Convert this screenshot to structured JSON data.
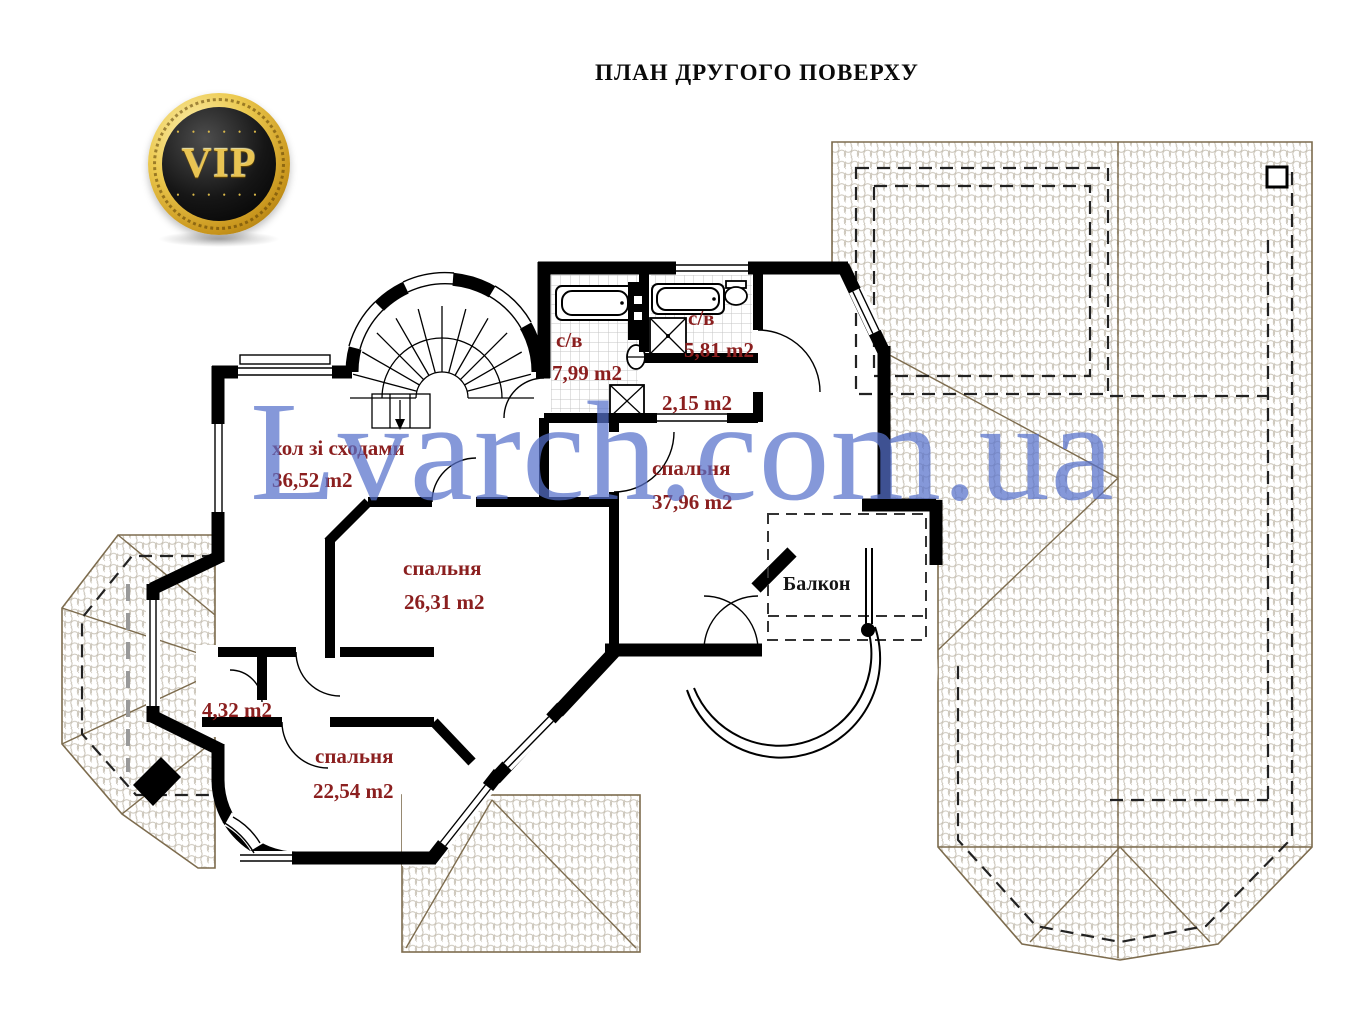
{
  "page": {
    "title": "ПЛАН ДРУГОГО ПОВЕРХУ"
  },
  "logo": {
    "label": "VIP",
    "dots": "• • • • • •"
  },
  "watermark": {
    "text": "Lvarch.com.ua",
    "color": "#5670ca"
  },
  "plan": {
    "rooms": [
      {
        "id": "hall",
        "name": "хол зі сходами",
        "area": "36,52 m2"
      },
      {
        "id": "bedroom-center",
        "name": "спальня",
        "area": "26,31 m2"
      },
      {
        "id": "bedroom-right",
        "name": "спальня",
        "area": "37,96 m2"
      },
      {
        "id": "bedroom-bottom",
        "name": "спальня",
        "area": "22,54 m2"
      },
      {
        "id": "bathroom-left",
        "name": "с/в",
        "area": "7,99 m2"
      },
      {
        "id": "bathroom-right",
        "name": "с/в",
        "area": "5,81 m2"
      },
      {
        "id": "closet-small",
        "name": "",
        "area": "2,15 m2"
      },
      {
        "id": "wardrobe",
        "name": "",
        "area": "4,32 m2"
      },
      {
        "id": "balcony",
        "name": "Балкон",
        "area": ""
      }
    ],
    "colors": {
      "walls": "#000000",
      "room_label": "#8b1f1f",
      "balcony_label": "#151515",
      "roof_outline": "#7d6c4e",
      "roof_hatch": "#c9c3b7",
      "tile_grid": "#c4c4c4"
    }
  }
}
